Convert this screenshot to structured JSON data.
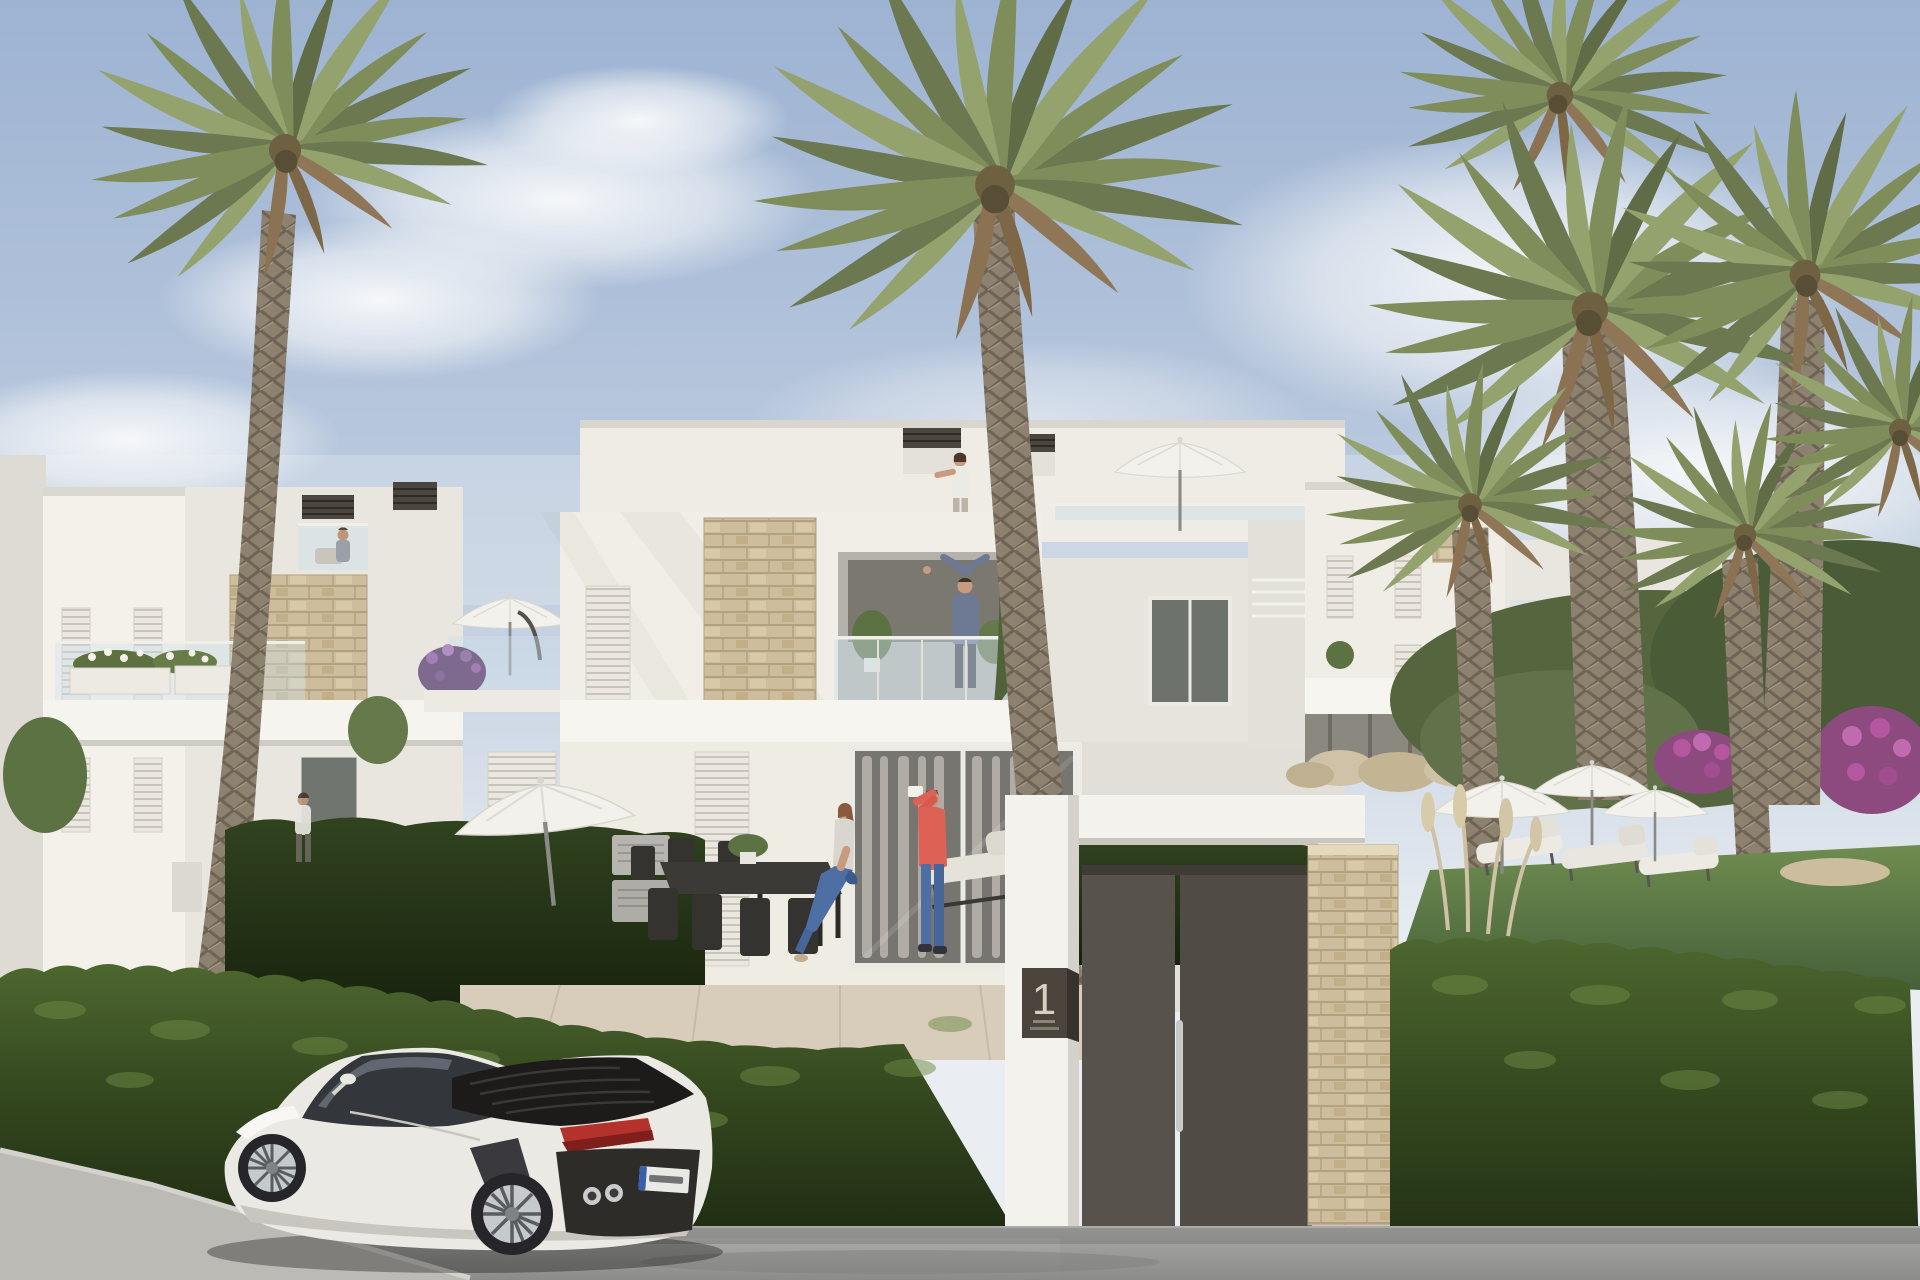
{
  "scene": {
    "description": "Sunny 3D architectural rendering of a modern white townhouse complex with tall palm trees, clipped green hedges, a communal garden with parasols and loungers, an entrance gate numbered 1, and a white sports coupe parked on the street",
    "sky": {
      "top_color": "#9db3d2",
      "horizon_color": "#eaeef2",
      "cloud_color": "#f7f9fb"
    },
    "buildings": {
      "wall_sunlit": "#f2efe8",
      "wall_shaded": "#dcd9d2",
      "stone_cladding": "#ccbb97",
      "shutter_style": "white louvered panels",
      "balustrade_style": "frameless glass",
      "pergola_color": "#4b463e"
    },
    "vegetation": {
      "palm_frond": "#7e8c5c",
      "palm_trunk": "#8d8170",
      "hedge": "#3d5326",
      "lawn": "#607e46",
      "bougainvillea": "#b457a0",
      "pampas": "#d3c6a6"
    },
    "street": {
      "asphalt": "#9d9d9b",
      "sidewalk": "#bcbab4"
    },
    "gate": {
      "plaque_number": "1",
      "plaque_caption_lines": 2,
      "door_color": "#56514a",
      "handle": "stainless vertical bar",
      "pillar_finish": "stone cladding"
    },
    "car": {
      "type": "white sports coupe",
      "body_color": "#ebe9e3",
      "taillight_color": "#b5322c",
      "engine_deck": "black slatted",
      "license_plate_text": ""
    },
    "people": [
      {
        "label": "woman waving on rooftop terrace"
      },
      {
        "label": "man with raised arms on first-floor balcony"
      },
      {
        "label": "man in coral jacket photographing on ground terrace"
      },
      {
        "label": "woman seated on terrace dining table"
      },
      {
        "label": "person walking along the hedge"
      },
      {
        "label": "person seated on left roof terrace"
      }
    ],
    "terrace": {
      "items": [
        "dark dining table with chairs",
        "potted plant",
        "sun lounger",
        "air-conditioning units",
        "cream cantilever parasol"
      ]
    },
    "garden": {
      "items": [
        "white parasols",
        "white sun loungers",
        "boulders",
        "pampas grass",
        "flowering shrubs"
      ]
    }
  }
}
